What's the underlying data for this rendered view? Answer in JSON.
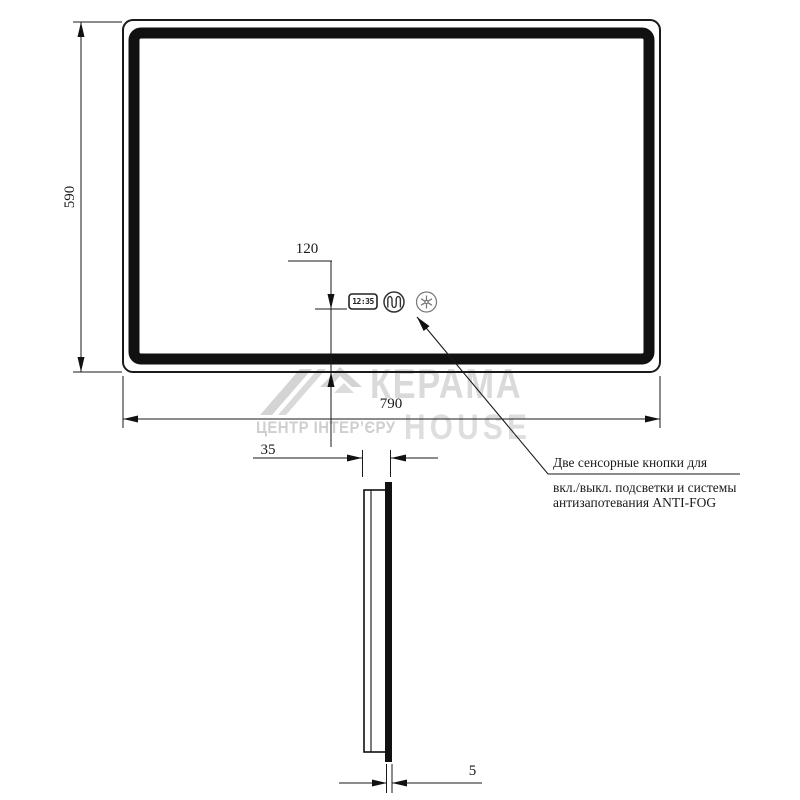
{
  "drawing": {
    "type": "mirror technical drawing, front and side view",
    "clock_time": "12:35"
  },
  "dimensions": {
    "height": "590",
    "width": "790",
    "buttons_offset": "120",
    "depth": "35",
    "glass_thickness": "5"
  },
  "annotation": {
    "line1": "Две сенсорные кнопки для",
    "line2": "вкл./выкл. подсветки и системы",
    "line3": "антизапотевания ANTI-FOG"
  },
  "watermark": {
    "brand_line1": "КЕРАМА",
    "brand_line2": "HOUSE",
    "tagline": "ЦЕНТР ІНТЕР’ЄРУ"
  },
  "icons": {
    "clock": "clock-display",
    "light_button": "backlight-touch-button-icon",
    "antifog_button": "antifog-touch-button-icon"
  },
  "colors": {
    "line": "#1a1a1a",
    "watermark_gray": "#d6d6d6"
  }
}
